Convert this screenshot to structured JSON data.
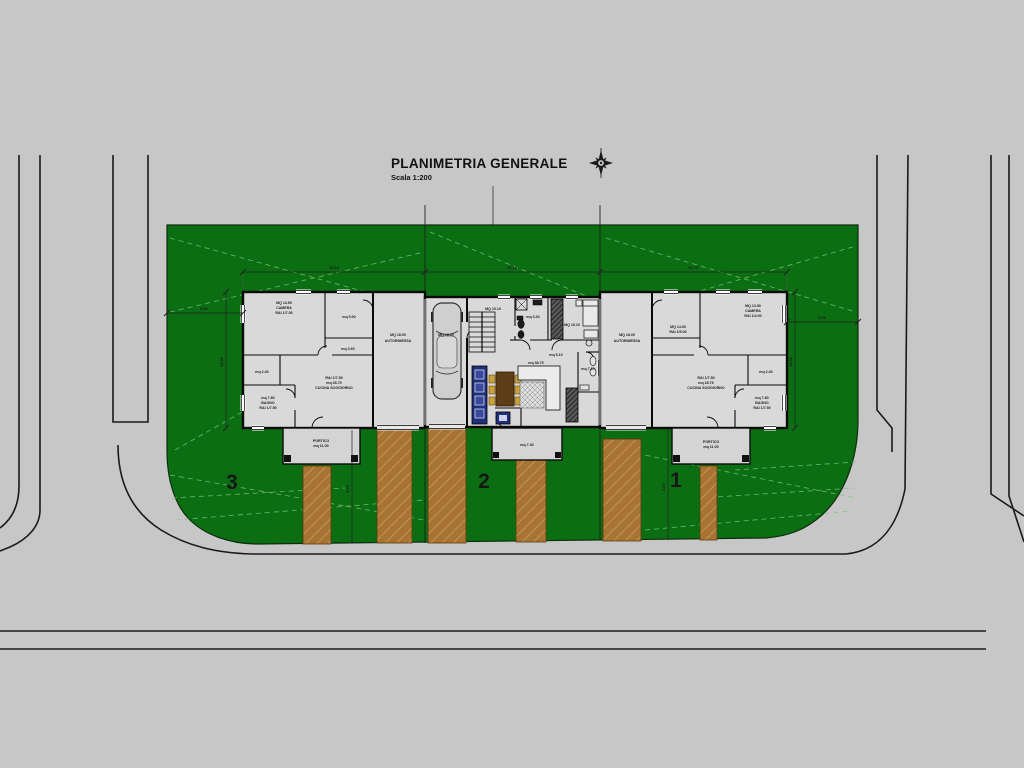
{
  "title": {
    "text": "PLANIMETRIA GENERALE",
    "scale": "Scala 1:200"
  },
  "lot_numbers": {
    "lot3": "3",
    "lot2": "2",
    "lot1": "1"
  },
  "colors": {
    "background": "#c7c7c7",
    "lawn_green": "#0c6e13",
    "contour_green": "#7cc47c",
    "path_brown": "#a87434",
    "path_hatch": "#c69c58",
    "building_fill": "#d9d9d9",
    "portico_fill": "#d4d4d4",
    "wall_black": "#0a0a0a",
    "kitchen_blue": "#20307a",
    "table_brown": "#5d3d16",
    "chair_gold": "#c9a23a"
  },
  "plan_labels": [
    {
      "id": "u3-camera-mq",
      "x": 284,
      "y": 304,
      "s": 3.6,
      "t": "MQ 13.50"
    },
    {
      "id": "u3-camera",
      "x": 284,
      "y": 309,
      "s": 3.6,
      "t": "CAMERA"
    },
    {
      "id": "u3-camera-rai",
      "x": 284,
      "y": 314,
      "s": 3.6,
      "t": "RAI 1/7.50"
    },
    {
      "id": "u3-room5",
      "x": 349,
      "y": 318,
      "s": 3.6,
      "t": "mq 5.00"
    },
    {
      "id": "u3-rip",
      "x": 262,
      "y": 373,
      "s": 3.6,
      "t": "mq 2.40"
    },
    {
      "id": "u3-bagno-mq",
      "x": 268,
      "y": 399,
      "s": 3.6,
      "t": "mq 7.80"
    },
    {
      "id": "u3-bagno",
      "x": 268,
      "y": 404,
      "s": 3.6,
      "t": "BAGNO"
    },
    {
      "id": "u3-bagno-rai",
      "x": 268,
      "y": 409,
      "s": 3.6,
      "t": "RAI 1/7.50"
    },
    {
      "id": "u3-living-rai",
      "x": 334,
      "y": 379,
      "s": 3.6,
      "t": "RAI 1/7.50"
    },
    {
      "id": "u3-living-mq",
      "x": 334,
      "y": 384,
      "s": 3.6,
      "t": "mq 28.75"
    },
    {
      "id": "u3-living",
      "x": 334,
      "y": 389,
      "s": 3.6,
      "t": "CUCINA SOGGIORNO"
    },
    {
      "id": "u3-hall",
      "x": 348,
      "y": 350,
      "s": 3.6,
      "t": "mq 3.60"
    },
    {
      "id": "u3-garage-mq",
      "x": 398,
      "y": 336,
      "s": 3.6,
      "t": "MQ 18.00"
    },
    {
      "id": "u3-garage",
      "x": 398,
      "y": 342,
      "s": 3.6,
      "t": "AUTORIMESSA"
    },
    {
      "id": "u3-portico",
      "x": 321,
      "y": 442,
      "s": 3.6,
      "t": "PORTICO"
    },
    {
      "id": "u3-portico-mq",
      "x": 321,
      "y": 447,
      "s": 3.6,
      "t": "mq 11.00"
    },
    {
      "id": "u2-garage-mq",
      "x": 446,
      "y": 336,
      "s": 3.6,
      "t": "MQ 18.00"
    },
    {
      "id": "u2-hall",
      "x": 493,
      "y": 310,
      "s": 3.6,
      "t": "MQ 10.10"
    },
    {
      "id": "u2-bath",
      "x": 533,
      "y": 318,
      "s": 3.6,
      "t": "mq 3.20"
    },
    {
      "id": "u2-bed-mq",
      "x": 572,
      "y": 326,
      "s": 3.6,
      "t": "MQ 15.10"
    },
    {
      "id": "u2-corr",
      "x": 556,
      "y": 356,
      "s": 3.6,
      "t": "mq 5.10"
    },
    {
      "id": "u2-bath2",
      "x": 588,
      "y": 370,
      "s": 3.6,
      "t": "mq 7.10"
    },
    {
      "id": "u2-living",
      "x": 536,
      "y": 364,
      "s": 3.6,
      "t": "mq 38.75"
    },
    {
      "id": "u2-patio-mq",
      "x": 527,
      "y": 446,
      "s": 3.6,
      "t": "mq 7.40"
    },
    {
      "id": "u1-garage-mq",
      "x": 627,
      "y": 336,
      "s": 3.6,
      "t": "MQ 18.00"
    },
    {
      "id": "u1-garage",
      "x": 627,
      "y": 342,
      "s": 3.6,
      "t": "AUTORIMESSA"
    },
    {
      "id": "u1-room14",
      "x": 678,
      "y": 328,
      "s": 3.6,
      "t": "MQ 14.00"
    },
    {
      "id": "u1-room14-rai",
      "x": 678,
      "y": 333,
      "s": 3.6,
      "t": "RAI 1/5.00"
    },
    {
      "id": "u1-camera-mq",
      "x": 753,
      "y": 307,
      "s": 3.6,
      "t": "MQ 13.50"
    },
    {
      "id": "u1-camera",
      "x": 753,
      "y": 312,
      "s": 3.6,
      "t": "CAMERA"
    },
    {
      "id": "u1-camera-rai",
      "x": 753,
      "y": 317,
      "s": 3.6,
      "t": "RAI 1/4.00"
    },
    {
      "id": "u1-rip",
      "x": 766,
      "y": 373,
      "s": 3.6,
      "t": "mq 2.40"
    },
    {
      "id": "u1-living-rai",
      "x": 706,
      "y": 379,
      "s": 3.6,
      "t": "RAI 1/7.50"
    },
    {
      "id": "u1-living-mq",
      "x": 706,
      "y": 384,
      "s": 3.6,
      "t": "mq 28.75"
    },
    {
      "id": "u1-living",
      "x": 706,
      "y": 389,
      "s": 3.6,
      "t": "CUCINA SOGGIORNO"
    },
    {
      "id": "u1-bagno-mq",
      "x": 762,
      "y": 399,
      "s": 3.6,
      "t": "mq 7.80"
    },
    {
      "id": "u1-bagno",
      "x": 762,
      "y": 404,
      "s": 3.6,
      "t": "BAGNO"
    },
    {
      "id": "u1-bagno-rai",
      "x": 762,
      "y": 409,
      "s": 3.6,
      "t": "RAI 1/7.50"
    },
    {
      "id": "u1-portico",
      "x": 711,
      "y": 443,
      "s": 3.6,
      "t": "PORTICO"
    },
    {
      "id": "u1-portico-mq",
      "x": 711,
      "y": 448,
      "s": 3.6,
      "t": "mq 11.00"
    },
    {
      "id": "dim-top-1",
      "x": 334,
      "y": 269,
      "s": 4,
      "t": "10.10"
    },
    {
      "id": "dim-top-2",
      "x": 512,
      "y": 269,
      "s": 4,
      "t": "10.10"
    },
    {
      "id": "dim-top-3",
      "x": 693,
      "y": 269,
      "s": 4,
      "t": "10.10"
    },
    {
      "id": "dim-left-h",
      "x": 204,
      "y": 310,
      "s": 4,
      "t": "5.00"
    },
    {
      "id": "dim-right-h",
      "x": 822,
      "y": 319,
      "s": 4,
      "t": "5.00"
    },
    {
      "id": "dim-left-v",
      "x": 223,
      "y": 362,
      "s": 4,
      "t": "12.50",
      "rot": -90
    },
    {
      "id": "dim-right-v",
      "x": 792,
      "y": 362,
      "s": 4,
      "t": "12.50",
      "rot": -90
    },
    {
      "id": "dim-drive-3",
      "x": 349,
      "y": 489,
      "s": 4,
      "t": "4.00",
      "rot": -90
    },
    {
      "id": "dim-drive-1",
      "x": 665,
      "y": 487,
      "s": 4,
      "t": "4.00",
      "rot": -90
    }
  ]
}
